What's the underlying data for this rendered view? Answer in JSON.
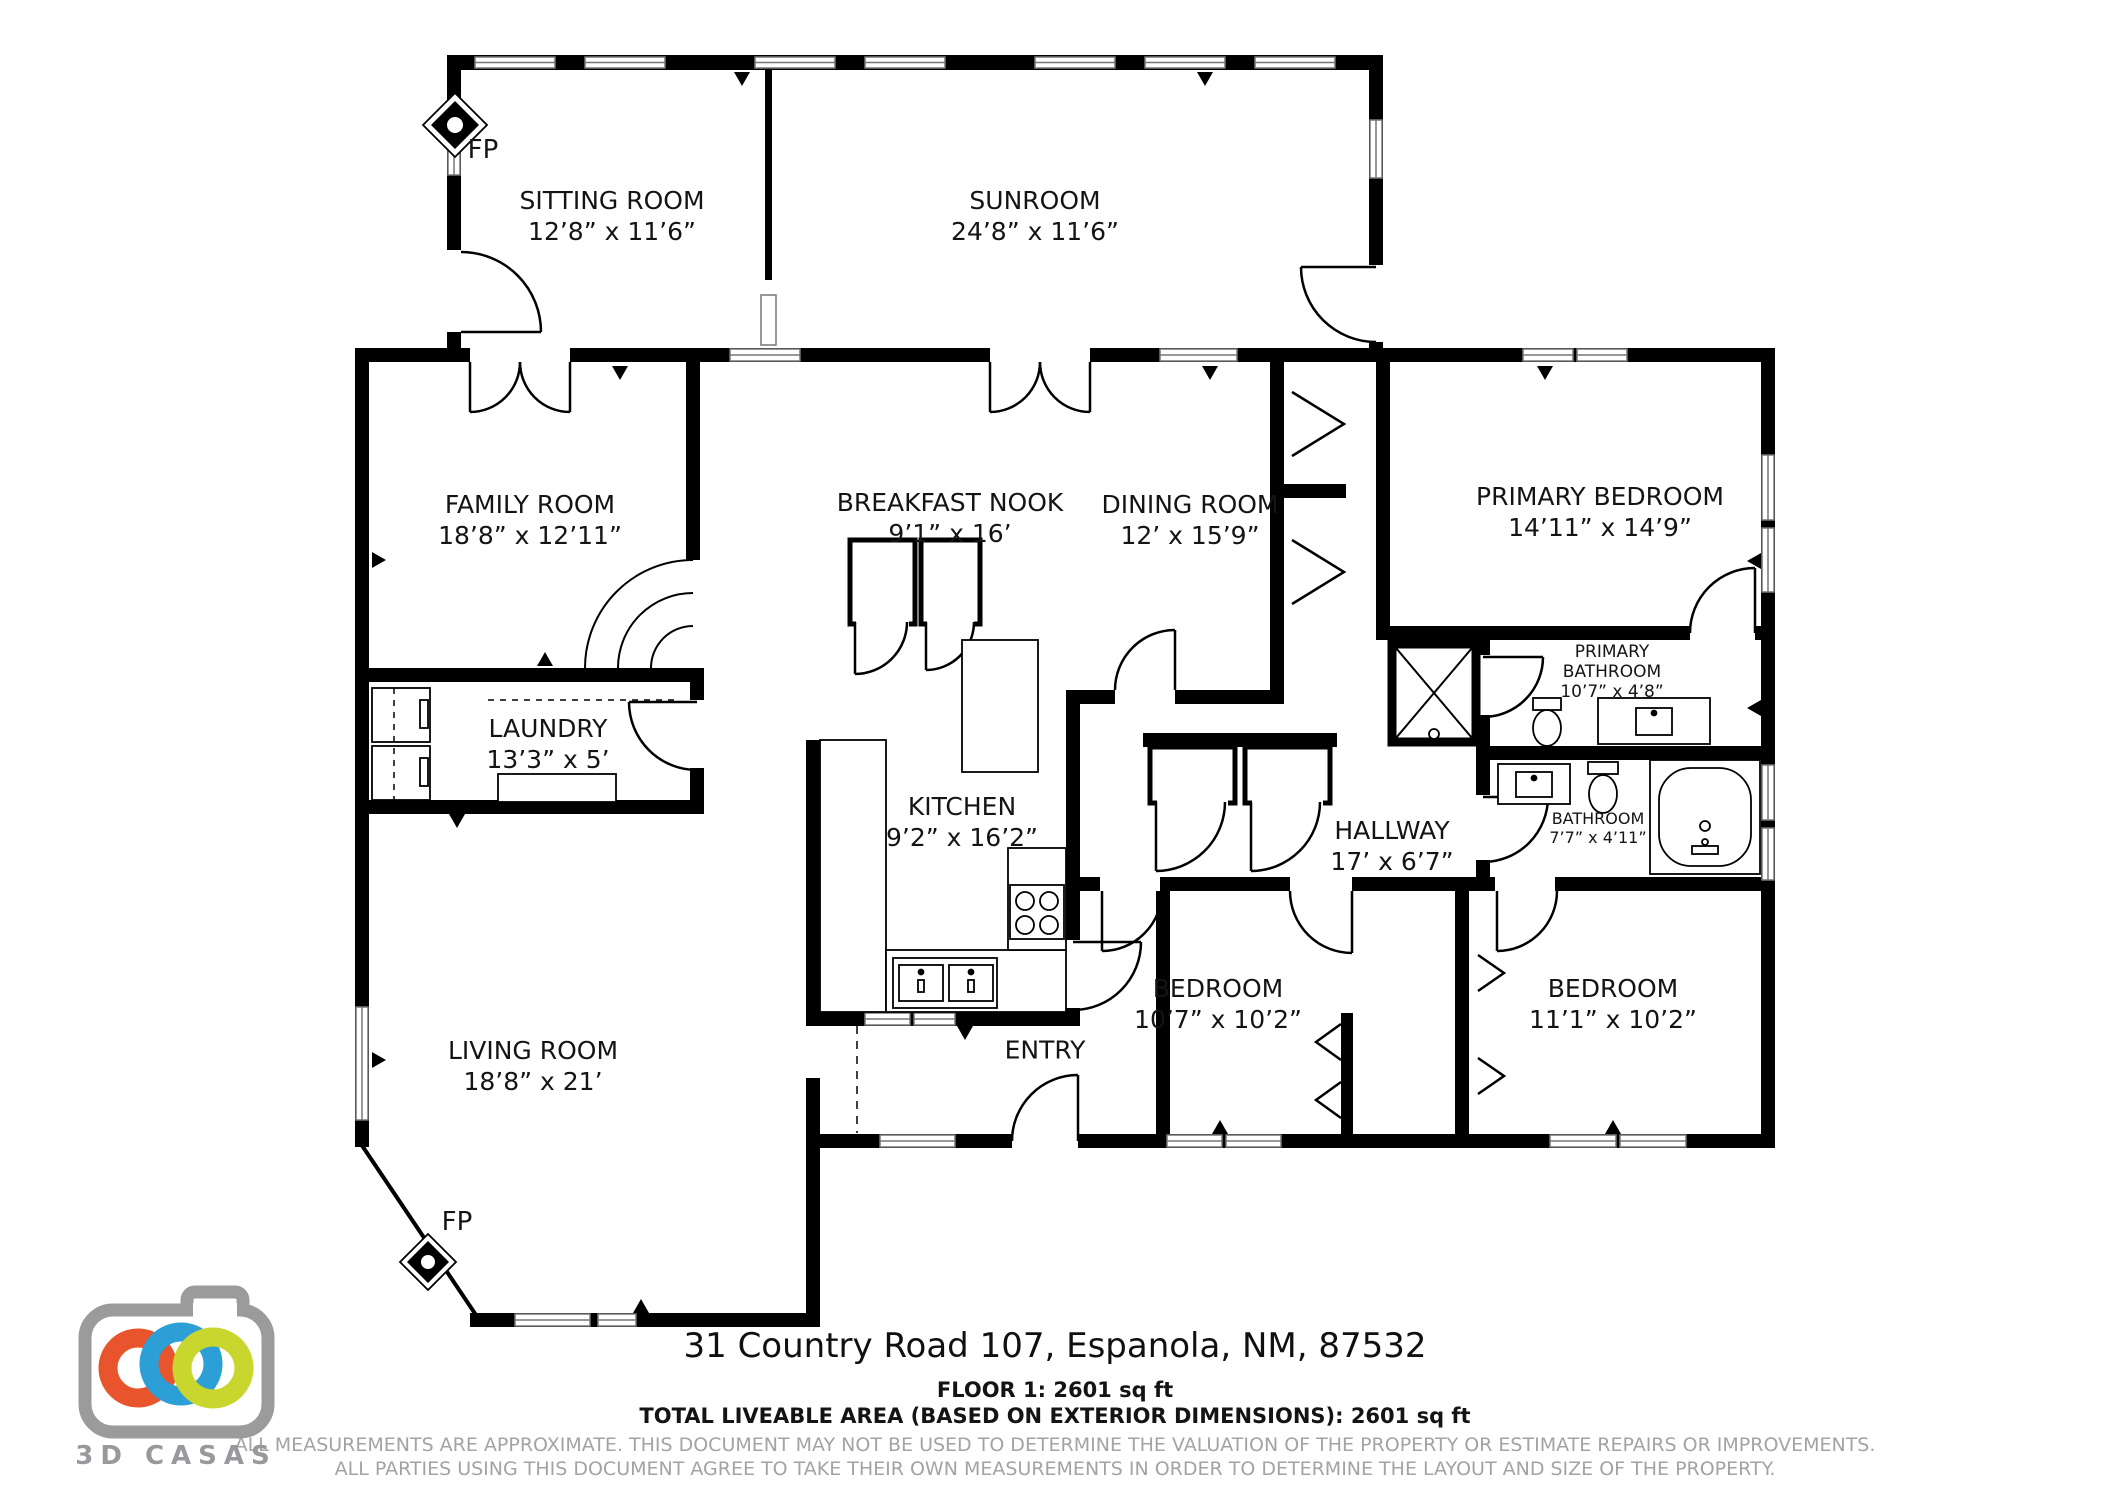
{
  "page": {
    "background": "#ffffff"
  },
  "branding": {
    "logo_text": "3D CASAS",
    "camera_gray": "#9b9b9b",
    "ring_orange": "#e8542c",
    "ring_blue": "#2b9fd6",
    "ring_green": "#c9d62e"
  },
  "labels": {
    "fireplace": "FP"
  },
  "rooms": {
    "sitting_room": {
      "name": "SITTING ROOM",
      "dims": "12’8” x 11’6”"
    },
    "sunroom": {
      "name": "SUNROOM",
      "dims": "24’8” x 11’6”"
    },
    "family_room": {
      "name": "FAMILY ROOM",
      "dims": "18’8” x 12’11”"
    },
    "breakfast_nook": {
      "name": "BREAKFAST NOOK",
      "dims": "9’1” x 16’"
    },
    "dining_room": {
      "name": "DINING ROOM",
      "dims": "12’ x 15’9”"
    },
    "primary_bedroom": {
      "name": "PRIMARY BEDROOM",
      "dims": "14’11” x 14’9”"
    },
    "laundry": {
      "name": "LAUNDRY",
      "dims": "13’3” x 5’"
    },
    "kitchen": {
      "name": "KITCHEN",
      "dims": "9’2” x 16’2”"
    },
    "hallway": {
      "name": "HALLWAY",
      "dims": "17’ x 6’7”"
    },
    "primary_bathroom": {
      "name": "PRIMARY BATHROOM",
      "dims": "10’7” x 4’8”"
    },
    "bathroom": {
      "name": "BATHROOM",
      "dims": "7’7” x 4’11”"
    },
    "living_room": {
      "name": "LIVING ROOM",
      "dims": "18’8” x 21’"
    },
    "entry": {
      "name": "ENTRY",
      "dims": ""
    },
    "bedroom_1": {
      "name": "BEDROOM",
      "dims": "10’7” x 10’2”"
    },
    "bedroom_2": {
      "name": "BEDROOM",
      "dims": "11’1” x 10’2”"
    }
  },
  "footer": {
    "address": "31 Country Road 107, Espanola, NM, 87532",
    "floor_line": "FLOOR 1: 2601 sq ft",
    "total_line": "TOTAL LIVEABLE AREA (BASED ON EXTERIOR DIMENSIONS): 2601 sq ft",
    "disclaimer1": "ALL MEASUREMENTS ARE APPROXIMATE. THIS DOCUMENT MAY NOT BE USED TO DETERMINE THE VALUATION OF THE PROPERTY OR ESTIMATE REPAIRS OR IMPROVEMENTS.",
    "disclaimer2": "ALL PARTIES USING THIS DOCUMENT AGREE TO TAKE THEIR OWN MEASUREMENTS IN ORDER TO DETERMINE THE LAYOUT AND SIZE OF THE PROPERTY."
  }
}
